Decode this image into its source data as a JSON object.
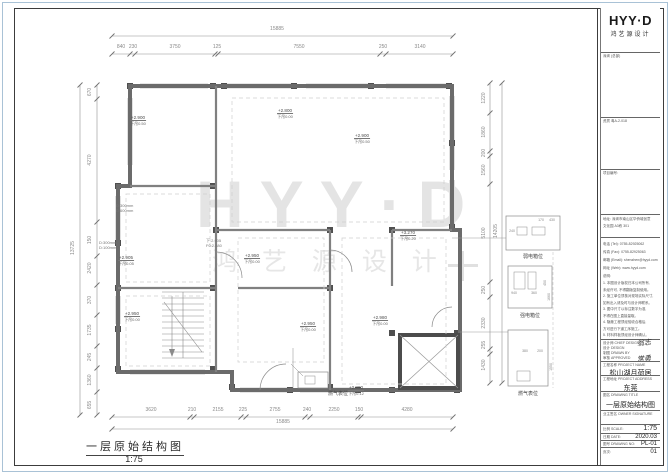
{
  "sheet": {
    "figure_title": "一层原始结构图",
    "figure_scale": "1:75"
  },
  "watermark": {
    "logo": "HYY·D",
    "name": "鸿 艺 源 设 计"
  },
  "dims": {
    "top_overall": "15885",
    "top_segments": [
      "840",
      "230",
      "3750",
      "125",
      "7550",
      "250",
      "3140"
    ],
    "bottom_overall": "15885",
    "bottom_segments": [
      "3620",
      "210",
      "2155",
      "225",
      "2755",
      "240",
      "2250",
      "150",
      "4280"
    ],
    "left_overall": "13725",
    "left_segments": [
      "670",
      "4270",
      "150",
      "2420",
      "370",
      "1735",
      "245",
      "1360",
      "655"
    ],
    "right_overall": "14205",
    "right_segments": [
      "1220",
      "1860",
      "200",
      "1560",
      "5100",
      "250",
      "2330",
      "255",
      "1430"
    ]
  },
  "plan": {
    "elevations": [
      {
        "v": "+2.900",
        "d": "下吊0.50"
      },
      {
        "v": "+2.800",
        "d": "下吊0.00"
      },
      {
        "v": "+2.900",
        "d": "下吊0.50"
      },
      {
        "v": "+3.270",
        "d": "下吊0.20"
      },
      {
        "v": "+2.905",
        "d": "下吊0.05"
      },
      {
        "v": "+2.950",
        "d": "下吊0.00"
      },
      {
        "v": "+2.950",
        "d": "下吊0.00"
      },
      {
        "v": "+2.950",
        "d": "下吊0.00"
      },
      {
        "v": "+2.980",
        "d": "下吊0.00"
      },
      {
        "v": "+2.880",
        "d": "下吊0.12"
      }
    ],
    "micro_labels": [
      {
        "l1": "D:300mm",
        "l2": "D:600mm"
      },
      {
        "l1": "D:300mm",
        "l2": "D:100mm"
      },
      {
        "l1": "下:2.905",
        "l2": "F0:2.880"
      }
    ],
    "gas_label": "燃气表位",
    "details": [
      {
        "caption": "弱电箱位",
        "d1": "170",
        "d2": "430",
        "d3": "240"
      },
      {
        "caption": "强电箱位",
        "d1": "940",
        "d2": "360",
        "d3": "450",
        "d4": "1660"
      },
      {
        "caption": "燃气表位",
        "d1": "380",
        "d2": "200",
        "d3": "1550"
      }
    ]
  },
  "titleblock": {
    "logo": "HYY·D",
    "logo_sub": "鸿艺源设计",
    "reg1": "深圳 (总部)",
    "reg2": "资质 粤A-2-018",
    "reg3": "项目编号:",
    "addr1": "地址: 深圳市南山区华侨城创意",
    "addr2": "文化园 A3栋 301",
    "tel": "电话 (Tel): 0755-82925062",
    "fax": "传真 (Fax): 0755-82925063",
    "email": "邮箱 (Email): shenzhen@hyyd.com",
    "web": "网址 (Web): www.hyyd.com",
    "notes_title": "说明:",
    "notes": [
      "1. 本图设计版权归本公司所有,",
      "未经许可, 不得翻版复制使用。",
      "2. 施工单位须核对现场实际尺寸,",
      "如有出入请及时与设计师联系。",
      "3. 图中尺寸以标注数字为准,",
      "不得在图上直接量取。",
      "4. 隐蔽工程须经验收合格后,",
      "方可进行下道工序施工。",
      "5. 材料样板须经设计师确认。"
    ],
    "rows": {
      "designer_label": "设计师 CHIEF DESIGN",
      "designer": "翁志",
      "design_label": "设计 DESIGN",
      "drawn_label": "制图 DRAWN BY",
      "approved_label": "审核 APPROVED",
      "approved": "常勇",
      "project_label": "工程名称 PROJECT NAME",
      "project": "松山湖月荷居",
      "addr_label": "工程地址 PROJECT ADDRESS",
      "addr": "东莞",
      "title_label": "图名 DRAWING TITLE",
      "title": "一层原始结构图",
      "owner_label": "业主签名 OWNER SIGNATURE",
      "scale_label": "比例 SCALE:",
      "scale": "1:75",
      "date_label": "日期 DATE:",
      "date": "2020.03",
      "no_label": "图号 DRAWING NO:",
      "no": "PL-01",
      "page_label": "页次:",
      "page": "01"
    }
  }
}
